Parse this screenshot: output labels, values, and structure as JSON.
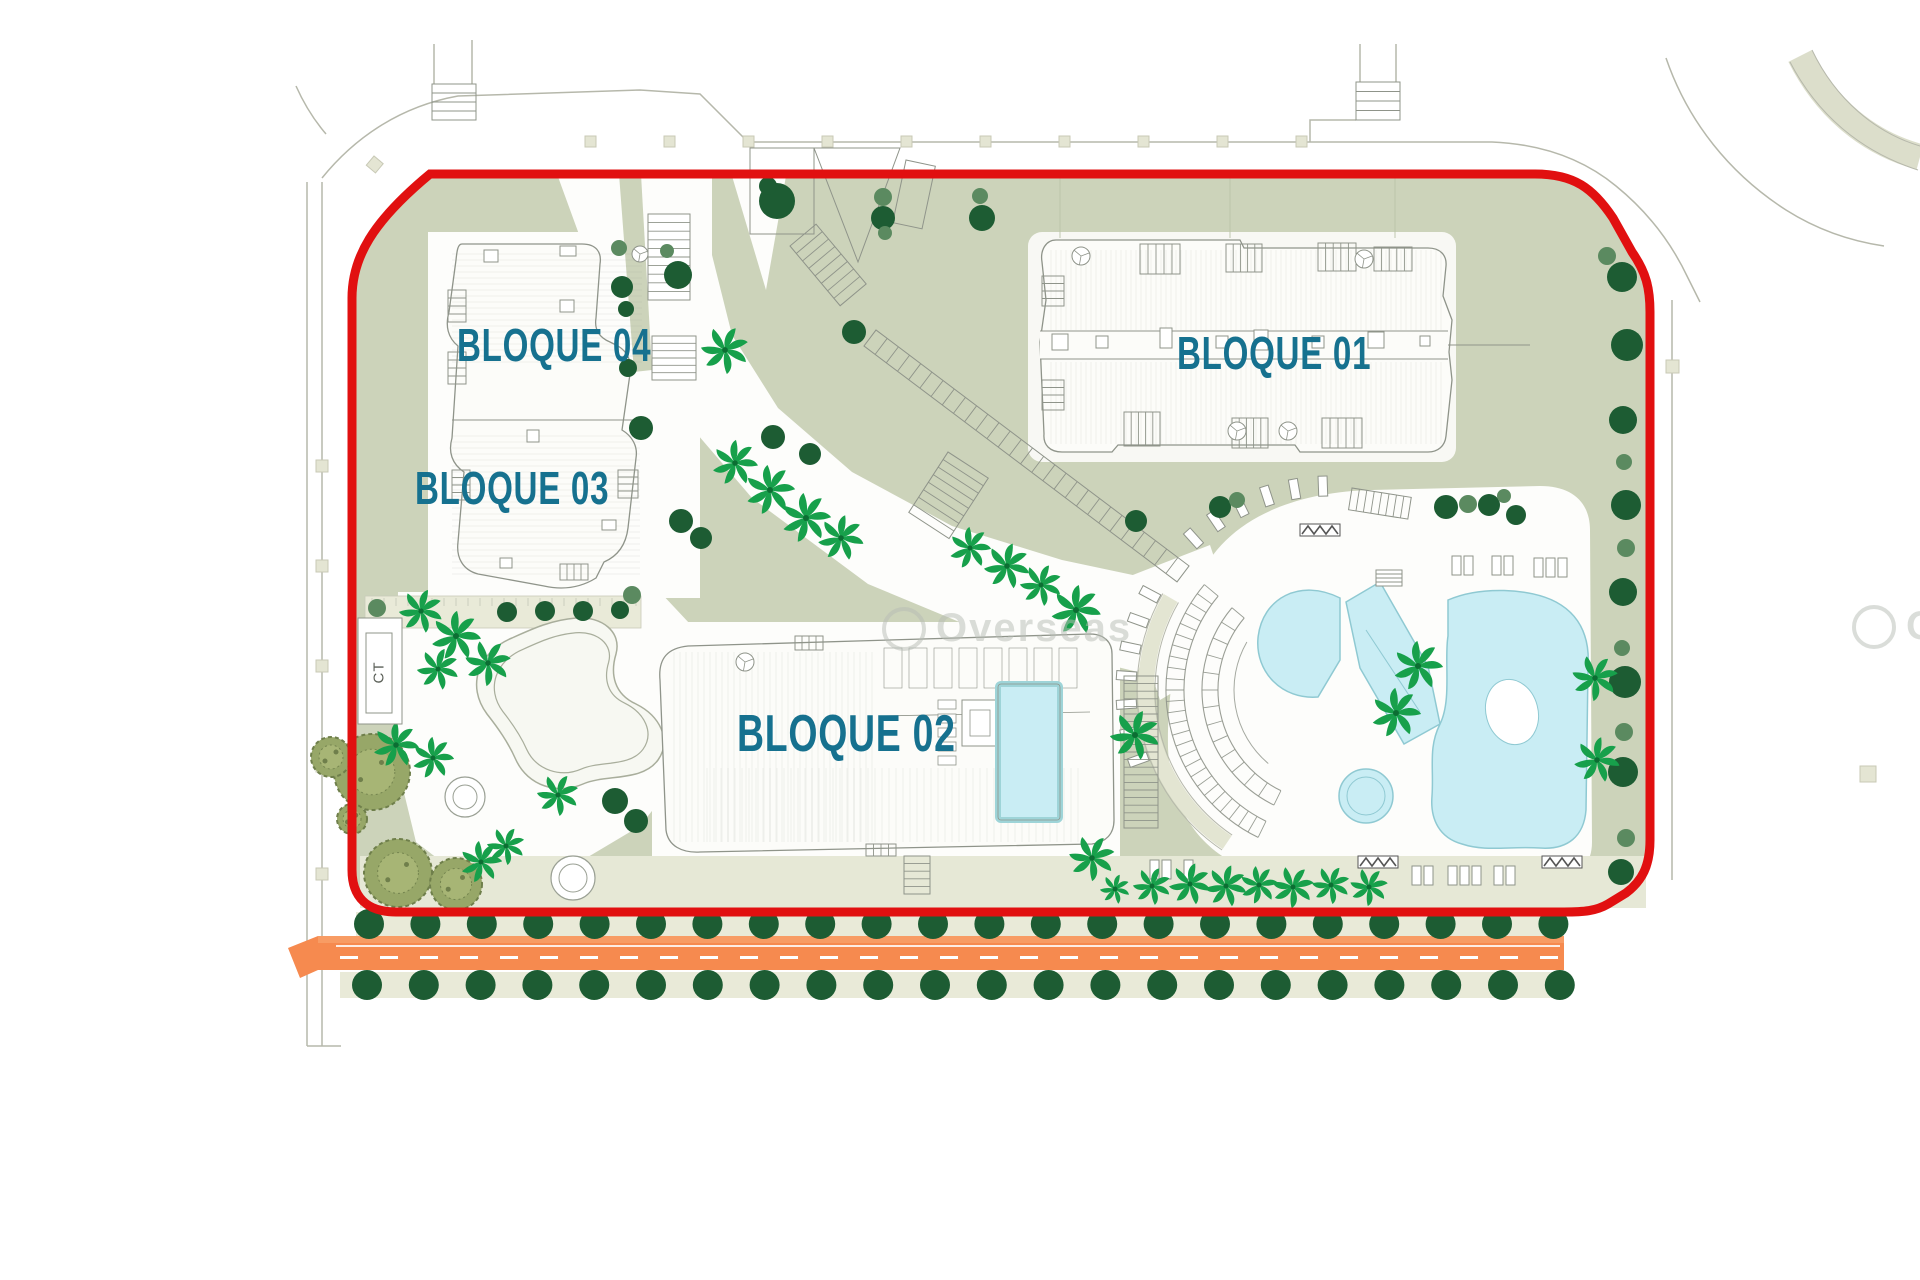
{
  "plan": {
    "labels": {
      "b01": "BLOQUE 01",
      "b02": "BLOQUE 02",
      "b03": "BLOQUE 03",
      "b04": "BLOQUE 04"
    },
    "ct_label": "CT",
    "watermark_text": "Overseas",
    "colors": {
      "boundary_red": "#e11010",
      "sage": "#ccd3ba",
      "sage_divider": "#bcc4a8",
      "beige": "#e9ead8",
      "path_beige": "#e3e5d2",
      "white_plaza": "#fdfdfb",
      "line_gray": "#b6b8ab",
      "building_fill": "#fcfcf9",
      "building_line": "#8f948a",
      "pool_fill": "#c9edf4",
      "pool_rim": "#8fc9d2",
      "pool_rim_thick": "#9ed4d8",
      "tree_dark": "#1d5c33",
      "tree_medium": "#5b8a60",
      "palm": "#17a04b",
      "palm_core": "#0c6e33",
      "olive_fill": "#97a768",
      "olive_inner": "#aab878",
      "olive_edge": "#6f7f4b",
      "road_orange": "#f68a4f",
      "road_orange_light": "#f89c64",
      "label_teal": "#16718f",
      "marker_beige": "#e4e5d3",
      "watermark_gray": "#b7bcb5"
    },
    "trees": {
      "dark": [
        [
          678,
          275,
          14
        ],
        [
          622,
          287,
          11
        ],
        [
          626,
          309,
          8
        ],
        [
          628,
          368,
          9
        ],
        [
          641,
          428,
          12
        ],
        [
          773,
          437,
          12
        ],
        [
          810,
          454,
          11
        ],
        [
          681,
          521,
          12
        ],
        [
          701,
          538,
          11
        ],
        [
          854,
          332,
          12
        ],
        [
          883,
          218,
          12
        ],
        [
          982,
          218,
          13
        ],
        [
          777,
          201,
          18
        ],
        [
          768,
          186,
          9
        ],
        [
          1136,
          521,
          11
        ],
        [
          1220,
          507,
          11
        ],
        [
          1446,
          507,
          12
        ],
        [
          1489,
          505,
          11
        ],
        [
          1516,
          515,
          10
        ],
        [
          615,
          801,
          13
        ],
        [
          636,
          821,
          12
        ],
        [
          1622,
          277,
          15
        ],
        [
          1627,
          345,
          16
        ],
        [
          1623,
          420,
          14
        ],
        [
          1626,
          505,
          15
        ],
        [
          1623,
          592,
          14
        ],
        [
          1625,
          682,
          16
        ],
        [
          1623,
          772,
          15
        ],
        [
          1621,
          872,
          13
        ],
        [
          507,
          612,
          10
        ],
        [
          545,
          611,
          10
        ],
        [
          583,
          611,
          10
        ],
        [
          620,
          610,
          9
        ]
      ],
      "medium": [
        [
          619,
          248,
          8
        ],
        [
          883,
          197,
          9
        ],
        [
          885,
          233,
          7
        ],
        [
          980,
          196,
          8
        ],
        [
          1237,
          500,
          8
        ],
        [
          1468,
          504,
          9
        ],
        [
          1504,
          496,
          7
        ],
        [
          377,
          608,
          9
        ],
        [
          632,
          595,
          9
        ],
        [
          1607,
          256,
          9
        ],
        [
          1624,
          462,
          8
        ],
        [
          1626,
          548,
          9
        ],
        [
          1622,
          648,
          8
        ],
        [
          1624,
          732,
          9
        ],
        [
          1626,
          838,
          9
        ],
        [
          667,
          251,
          7
        ]
      ],
      "palms": [
        [
          725,
          350,
          24
        ],
        [
          735,
          463,
          23
        ],
        [
          770,
          490,
          25
        ],
        [
          806,
          518,
          25
        ],
        [
          841,
          538,
          23
        ],
        [
          970,
          548,
          21
        ],
        [
          1007,
          566,
          23
        ],
        [
          1041,
          585,
          21
        ],
        [
          1076,
          610,
          25
        ],
        [
          1135,
          735,
          25
        ],
        [
          1092,
          858,
          23
        ],
        [
          1418,
          666,
          25
        ],
        [
          1396,
          713,
          25
        ],
        [
          1595,
          678,
          23
        ],
        [
          1597,
          760,
          23
        ],
        [
          421,
          611,
          22
        ],
        [
          456,
          636,
          25
        ],
        [
          488,
          663,
          23
        ],
        [
          438,
          669,
          21
        ],
        [
          396,
          745,
          23
        ],
        [
          433,
          758,
          21
        ],
        [
          558,
          795,
          21
        ],
        [
          506,
          846,
          19
        ],
        [
          481,
          862,
          21
        ],
        [
          1152,
          886,
          19
        ],
        [
          1190,
          884,
          21
        ],
        [
          1226,
          886,
          21
        ],
        [
          1259,
          885,
          19
        ],
        [
          1293,
          887,
          21
        ],
        [
          1331,
          885,
          19
        ],
        [
          1369,
          887,
          19
        ],
        [
          1115,
          889,
          15
        ]
      ],
      "olives": [
        [
          372,
          772,
          38
        ],
        [
          331,
          757,
          20
        ],
        [
          398,
          873,
          34
        ],
        [
          456,
          884,
          26
        ],
        [
          352,
          819,
          15
        ]
      ]
    },
    "tree_rows": [
      {
        "y": 924,
        "x0": 369,
        "step": 56.4,
        "count": 22,
        "r": 15
      },
      {
        "y": 985,
        "x0": 367,
        "step": 56.8,
        "count": 22,
        "r": 15
      }
    ]
  }
}
